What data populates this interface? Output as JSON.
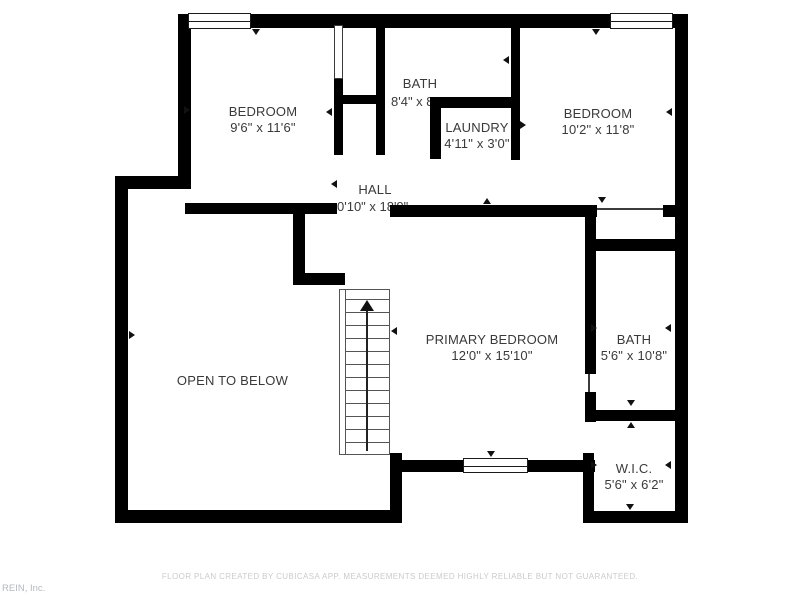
{
  "rooms": {
    "bedroom_left": {
      "name": "BEDROOM",
      "dims": "9'6\" x 11'6\""
    },
    "bath_top": {
      "name": "BATH",
      "dims": "8'4\" x 8"
    },
    "laundry": {
      "name": "LAUNDRY",
      "dims": "4'11\" x 3'0\""
    },
    "bedroom_right": {
      "name": "BEDROOM",
      "dims": "10'2\" x 11'8\""
    },
    "hall": {
      "name": "HALL",
      "dims": "0'10\" x 18'9\""
    },
    "primary_bedroom": {
      "name": "PRIMARY BEDROOM",
      "dims": "12'0\" x 15'10\""
    },
    "bath_right": {
      "name": "BATH",
      "dims": "5'6\" x 10'8\""
    },
    "open_to_below": {
      "name": "OPEN TO BELOW"
    },
    "wic": {
      "name": "W.I.C.",
      "dims": "5'6\" x 6'2\""
    }
  },
  "footer": {
    "disclaimer": "FLOOR PLAN CREATED BY CUBICASA APP. MEASUREMENTS DEEMED HIGHLY RELIABLE BUT NOT GUARANTEED.",
    "attribution": "REIN, Inc."
  },
  "colors": {
    "wall": "#000000",
    "background": "#ffffff",
    "label_text": "#3a3a3a",
    "footer_text": "#cbcbcb",
    "watermark_text": "#b3b9c1"
  }
}
